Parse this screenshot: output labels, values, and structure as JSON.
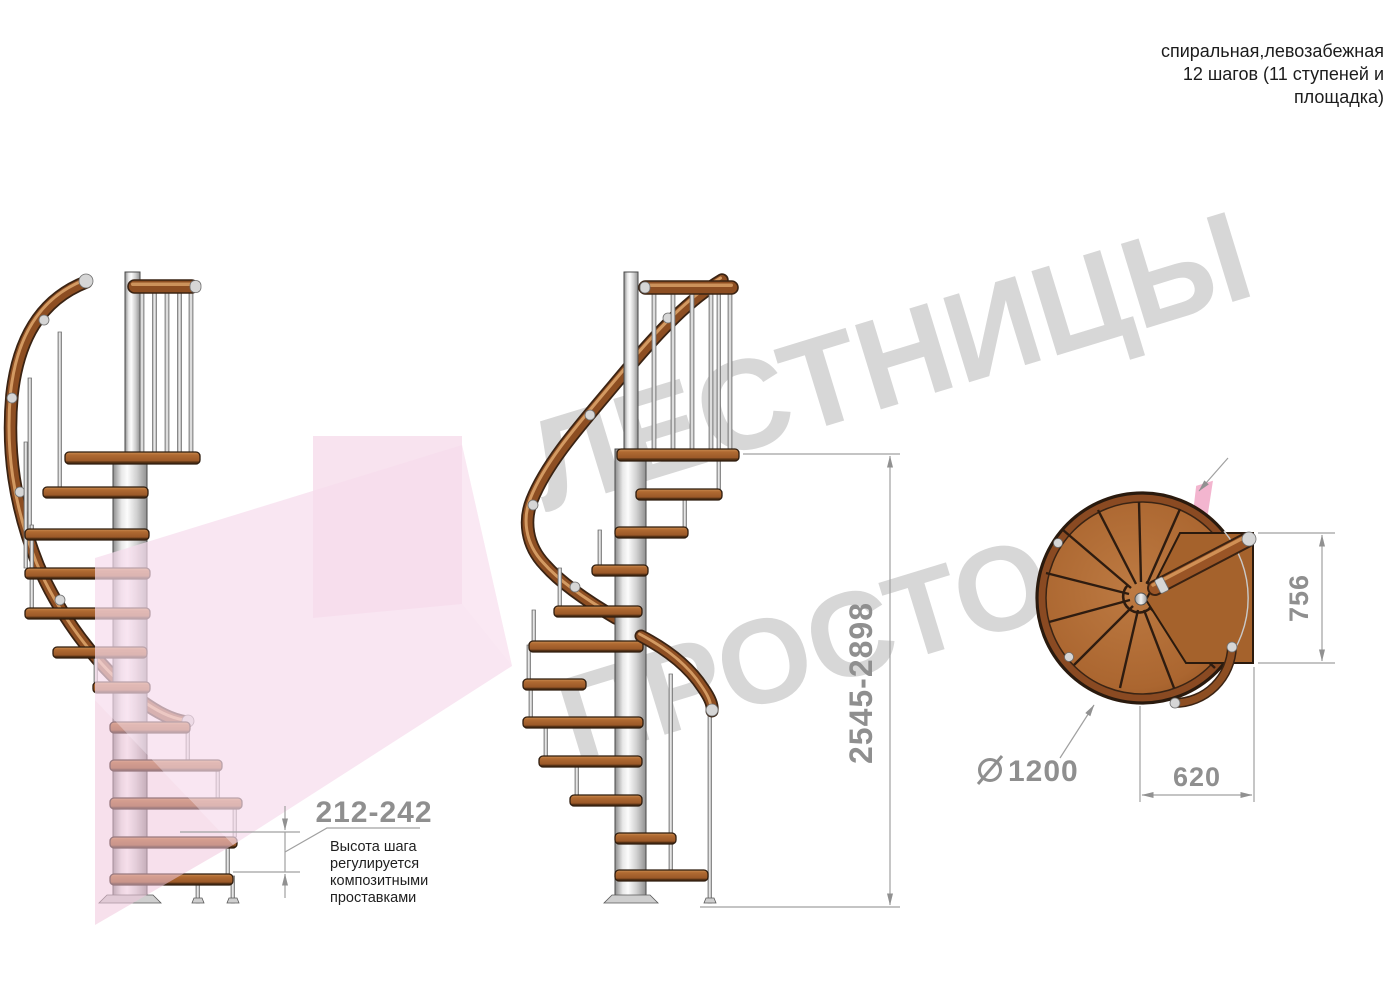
{
  "header": {
    "line1": "спиральная,левозабежная",
    "line2": "12 шагов (11 ступеней и",
    "line3": "площадка)"
  },
  "watermark": {
    "line1": "ЛЕСТНИЦЫ",
    "line2_gray": "ПРОСТО",
    "line2_pink": ".РУ",
    "gray_color": "#d7d7d7",
    "pink_color": "#f3b5cf",
    "arrow_pink_color": "#f7dcec"
  },
  "dimensions": {
    "step_height": {
      "value": "212-242",
      "note_lines": [
        "Высота шага",
        "регулируется",
        "композитными",
        "проставками"
      ]
    },
    "total_height": {
      "value": "2545-2898"
    },
    "landing_depth": {
      "value": "756"
    },
    "landing_width": {
      "value": "620"
    },
    "diameter": {
      "value": "1200",
      "symbol": "diameter-sign"
    }
  },
  "colors": {
    "wood": "#a5622b",
    "wood_dark": "#3a2313",
    "wood_light": "#d39a62",
    "metal": "#e8e8e8",
    "dimension_gray": "#8f8f8f",
    "note_black": "#1f1f1f"
  }
}
